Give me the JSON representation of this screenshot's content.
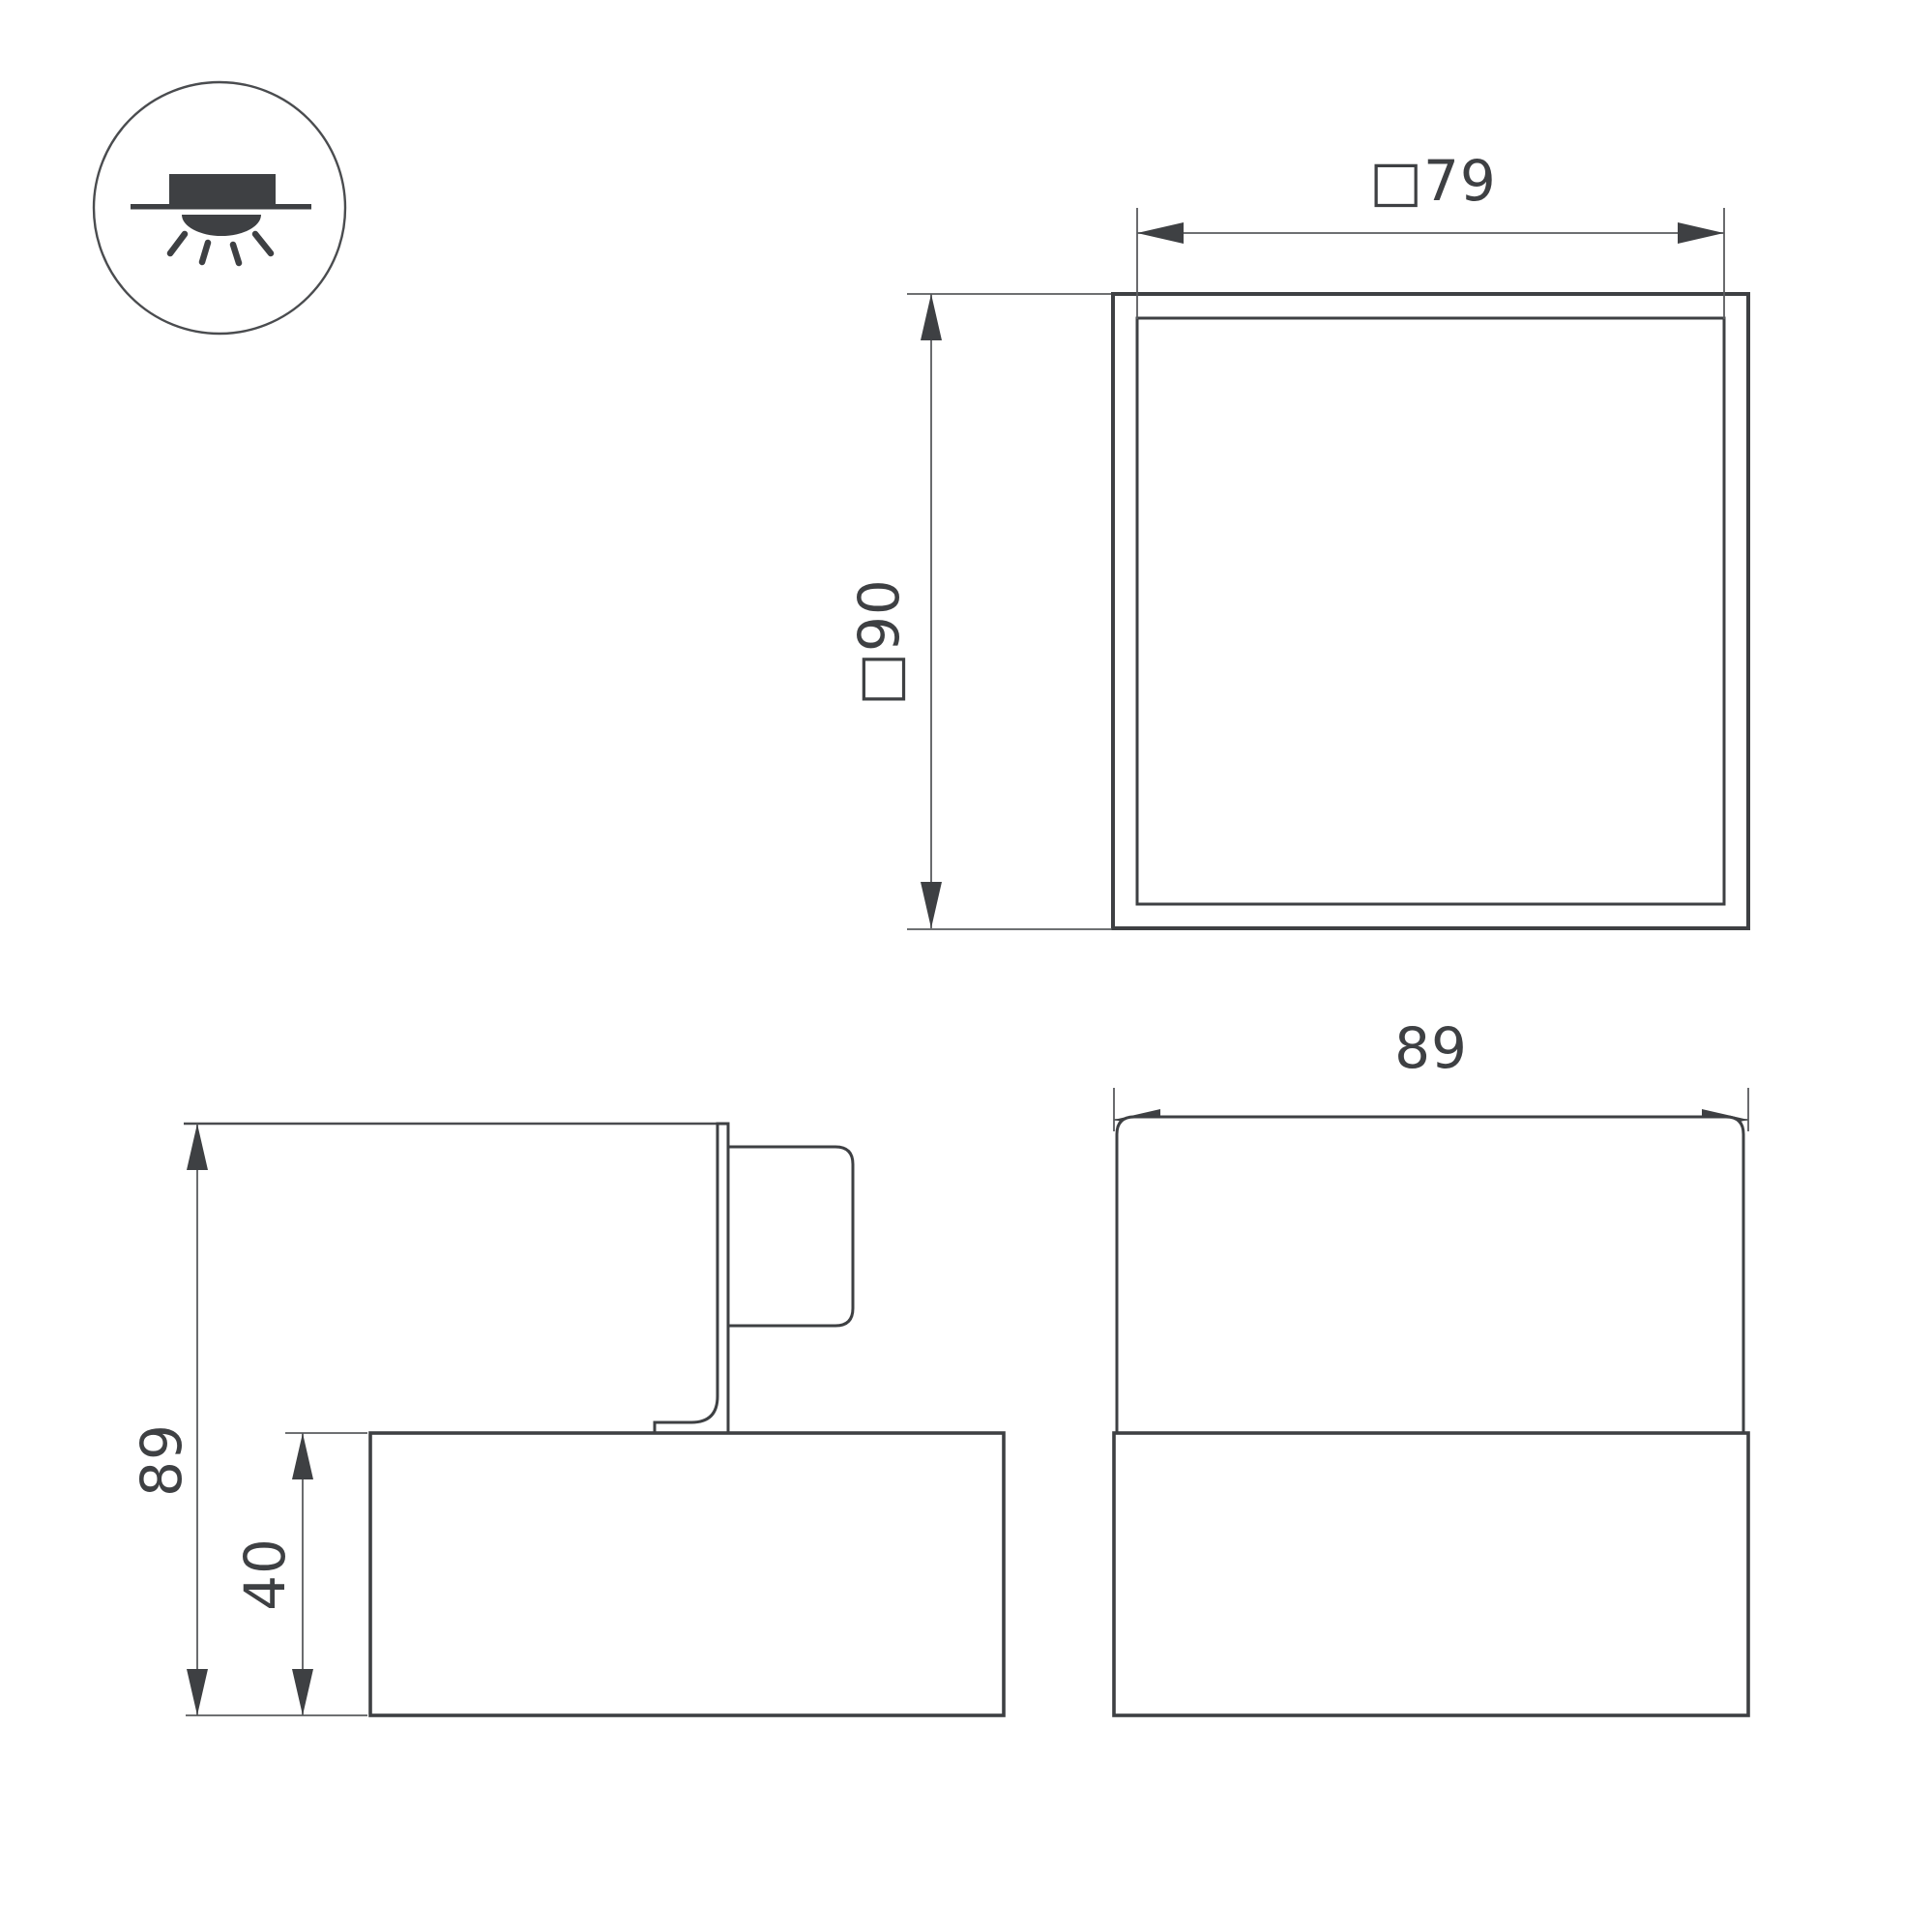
{
  "document": {
    "type": "luminaire-dimension-drawing",
    "background": "#ffffff"
  },
  "icon": {
    "name": "surface-mounted-downlight-icon",
    "description": "circle badge with surface mounted fixture above ceiling line, light dome and rays below"
  },
  "views": {
    "plan": {
      "name": "top-view",
      "width_label": "□79",
      "height_label": "□90"
    },
    "side": {
      "name": "side-view",
      "height_label": "89",
      "body_height_label": "40"
    },
    "front": {
      "name": "front-view",
      "width_label": "89"
    }
  },
  "colors": {
    "line_dark": "#3E4043",
    "line_thin": "#595B5E",
    "text": "#3E4043",
    "background": "#ffffff"
  }
}
